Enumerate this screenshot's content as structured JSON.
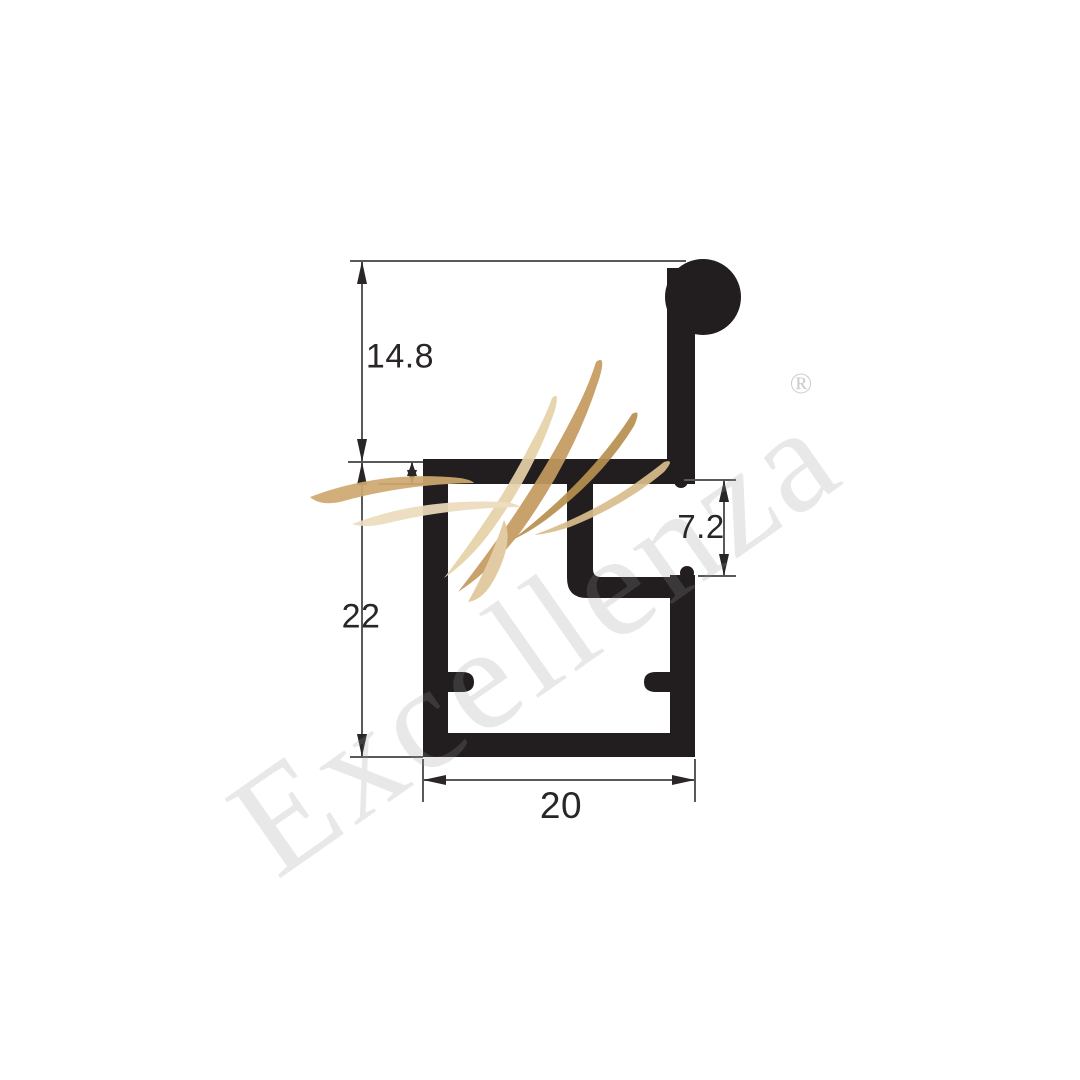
{
  "drawing": {
    "dimensions": {
      "height_top": "14.8",
      "height_left": "22",
      "notch_depth": "7.2",
      "width_bottom": "20"
    },
    "watermark": {
      "brand": "Excellenza",
      "registered": "®"
    },
    "colors": {
      "background": "#ffffff",
      "profile": "#221e1f",
      "dimension_lines": "#58595b",
      "dimension_text": "#2a2627",
      "watermark_gold": "#c59a5f"
    }
  }
}
